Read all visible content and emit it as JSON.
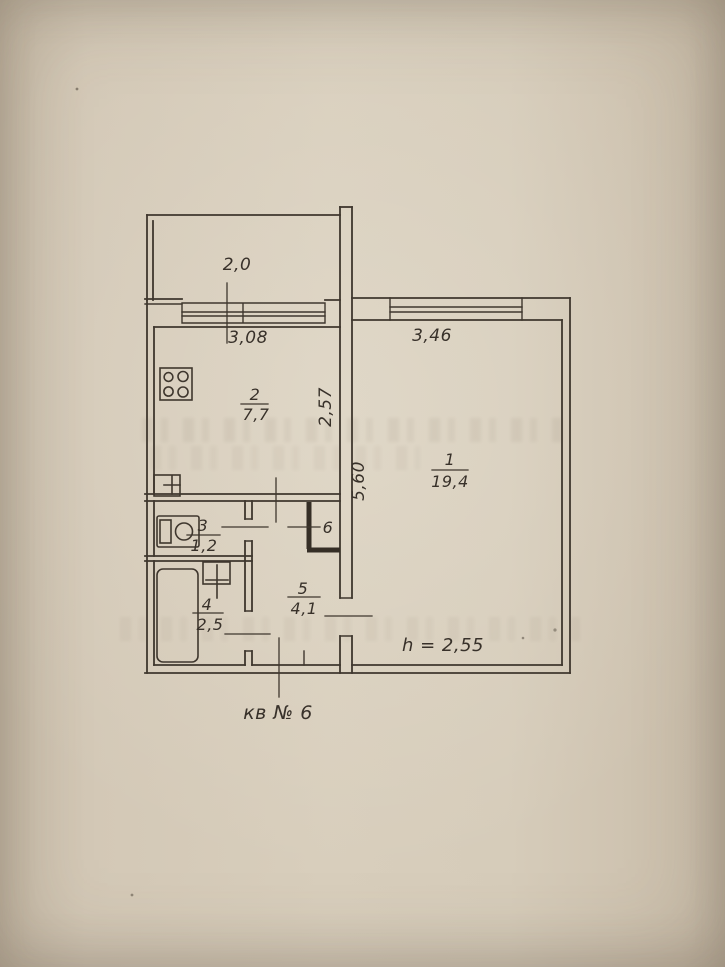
{
  "plan": {
    "apartment_label": "кв № 6",
    "ceiling_height_label": "h = 2,55",
    "dimensions": {
      "balcony": "2,0",
      "kitchen_width": "3,08",
      "kitchen_depth": "2,57",
      "living_width": "3,46",
      "living_depth": "5,60"
    },
    "rooms": [
      {
        "number": "1",
        "area": "19,4"
      },
      {
        "number": "2",
        "area": "7,7"
      },
      {
        "number": "3",
        "area": "1,2"
      },
      {
        "number": "4",
        "area": "2,5"
      },
      {
        "number": "5",
        "area": "4,1"
      },
      {
        "number": "6"
      }
    ],
    "colors": {
      "ink": "#3f372e",
      "paper": "#d6ccba"
    }
  }
}
